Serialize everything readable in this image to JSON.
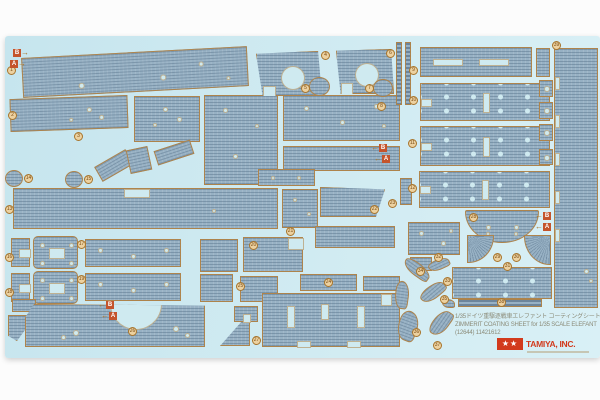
{
  "sheet": {
    "x": 5,
    "y": 36,
    "w": 595,
    "h": 322
  },
  "palette": {
    "sheet_bg": "#cfeaf1",
    "piece": "#97b1c4",
    "ridge": "rgba(54,80,106,0.30)",
    "outline": "#b08246",
    "hole": "#cfeaf0",
    "label_bg": "#ecd1a0",
    "label_ring": "#a8752c",
    "marker_bg": "#c4542c",
    "marker_text": "#ffffff",
    "footer_text": "#8b8b78",
    "logo_red": "#d23a1c"
  },
  "footer": {
    "line_jp": "1/35ドイツ重駆逐戦車エレファント コーティングシートセット",
    "line_en": "ZIMMERIT COATING SHEET for 1/35 SCALE ELEFANT",
    "line_code": "(12644) 11421612",
    "logo_stars": "★★",
    "logo_text": "TAMIYA, INC."
  },
  "pieces": [
    {
      "id": "hull-top-band",
      "x": 22,
      "y": 52,
      "w": 226,
      "h": 40,
      "rot": -3,
      "holes": [
        {
          "x": 140,
          "y": 26,
          "r": 3
        },
        {
          "x": 58,
          "y": 30,
          "r": 3
        },
        {
          "x": 178,
          "y": 14,
          "r": 2.5
        },
        {
          "x": 205,
          "y": 30,
          "r": 2
        }
      ]
    },
    {
      "id": "band-2",
      "x": 10,
      "y": 97,
      "w": 118,
      "h": 33,
      "rot": -2,
      "holes": [
        {
          "x": 78,
          "y": 12,
          "r": 2.5
        },
        {
          "x": 90,
          "y": 20,
          "r": 2.5
        },
        {
          "x": 60,
          "y": 22,
          "r": 2
        }
      ]
    },
    {
      "id": "band-3",
      "x": 134,
      "y": 96,
      "w": 66,
      "h": 46,
      "holes": [
        {
          "x": 30,
          "y": 12,
          "r": 2.5
        },
        {
          "x": 44,
          "y": 22,
          "r": 2.5
        },
        {
          "x": 20,
          "y": 28,
          "r": 2
        }
      ]
    },
    {
      "id": "center-tall",
      "x": 204,
      "y": 95,
      "w": 74,
      "h": 90,
      "holes": [
        {
          "x": 20,
          "y": 14,
          "r": 2.5
        },
        {
          "x": 52,
          "y": 30,
          "r": 2
        },
        {
          "x": 30,
          "y": 60,
          "r": 2.5
        }
      ]
    },
    {
      "id": "wide-band",
      "x": 283,
      "y": 95,
      "w": 117,
      "h": 46,
      "holes": [
        {
          "x": 22,
          "y": 12,
          "r": 2.5
        },
        {
          "x": 58,
          "y": 26,
          "r": 2.5
        },
        {
          "x": 92,
          "y": 10,
          "r": 2.5
        },
        {
          "x": 100,
          "y": 30,
          "r": 2
        }
      ]
    },
    {
      "id": "wide-band-2",
      "x": 283,
      "y": 146,
      "w": 117,
      "h": 25
    },
    {
      "id": "small-holes-bar",
      "x": 258,
      "y": 169,
      "w": 57,
      "h": 17,
      "holes": [
        {
          "x": 14,
          "y": 8,
          "r": 2
        },
        {
          "x": 40,
          "y": 8,
          "r": 2
        }
      ]
    },
    {
      "id": "trap-hole-1",
      "x": 256,
      "y": 51,
      "w": 66,
      "h": 45,
      "clip": "polygon(0 6%, 94% 0, 100% 100%, 10% 100%)",
      "holes": [
        {
          "x": 36,
          "y": 26,
          "r": 12
        }
      ],
      "cuts": [
        {
          "x": 6,
          "y": 34,
          "w": 13,
          "h": 12
        }
      ]
    },
    {
      "id": "trap-hole-2",
      "x": 336,
      "y": 49,
      "w": 58,
      "h": 45,
      "clip": "polygon(0 4%, 95% 0, 100% 100%, 8% 100%)",
      "holes": [
        {
          "x": 30,
          "y": 25,
          "r": 12
        }
      ],
      "cuts": [
        {
          "x": 4,
          "y": 33,
          "w": 12,
          "h": 13
        }
      ]
    },
    {
      "id": "disc-5",
      "x": 309,
      "y": 77,
      "w": 21,
      "h": 19,
      "shape": "disc"
    },
    {
      "id": "disc-7",
      "x": 373,
      "y": 79,
      "w": 20,
      "h": 18,
      "shape": "disc"
    },
    {
      "id": "strip-1",
      "x": 396,
      "y": 42,
      "w": 6,
      "h": 63,
      "dash": true
    },
    {
      "id": "strip-2",
      "x": 405,
      "y": 42,
      "w": 6,
      "h": 63,
      "dash": true
    },
    {
      "id": "slot-bar",
      "x": 420,
      "y": 47,
      "w": 112,
      "h": 30,
      "cuts": [
        {
          "x": 12,
          "y": 11,
          "w": 30,
          "h": 7
        },
        {
          "x": 58,
          "y": 11,
          "w": 30,
          "h": 7
        }
      ]
    },
    {
      "id": "bar-end",
      "x": 536,
      "y": 48,
      "w": 14,
      "h": 29
    },
    {
      "id": "skirt-1",
      "x": 420,
      "y": 83,
      "w": 130,
      "h": 38,
      "dots": true,
      "cuts": [
        {
          "x": 0,
          "y": 15,
          "w": 11,
          "h": 8
        },
        {
          "x": 62,
          "y": 9,
          "w": 7,
          "h": 20
        }
      ]
    },
    {
      "id": "skirt-2",
      "x": 420,
      "y": 126,
      "w": 130,
      "h": 40,
      "dots": true,
      "cuts": [
        {
          "x": 0,
          "y": 16,
          "w": 11,
          "h": 8
        },
        {
          "x": 62,
          "y": 10,
          "w": 7,
          "h": 20
        }
      ]
    },
    {
      "id": "skirt-3",
      "x": 419,
      "y": 171,
      "w": 131,
      "h": 37,
      "dots": true,
      "cuts": [
        {
          "x": 0,
          "y": 14,
          "w": 11,
          "h": 8
        },
        {
          "x": 62,
          "y": 8,
          "w": 7,
          "h": 20
        }
      ]
    },
    {
      "id": "tall-right",
      "x": 554,
      "y": 48,
      "w": 44,
      "h": 260,
      "cuts": [
        {
          "x": 0,
          "y": 28,
          "w": 5,
          "h": 13
        },
        {
          "x": 0,
          "y": 66,
          "w": 5,
          "h": 13
        },
        {
          "x": 0,
          "y": 104,
          "w": 5,
          "h": 13
        },
        {
          "x": 0,
          "y": 142,
          "w": 5,
          "h": 13
        },
        {
          "x": 0,
          "y": 180,
          "w": 5,
          "h": 13
        }
      ],
      "holes": [
        {
          "x": 31,
          "y": 222,
          "r": 2.5
        },
        {
          "x": 36,
          "y": 232,
          "r": 2
        }
      ]
    },
    {
      "id": "eyelet-sq-1",
      "x": 539,
      "y": 80,
      "w": 14,
      "h": 17,
      "holes": [
        {
          "x": 7,
          "y": 8,
          "r": 3
        }
      ]
    },
    {
      "id": "eyelet-sq-2",
      "x": 539,
      "y": 102,
      "w": 14,
      "h": 17,
      "holes": [
        {
          "x": 7,
          "y": 8,
          "r": 3
        }
      ]
    },
    {
      "id": "eyelet-sq-3",
      "x": 539,
      "y": 124,
      "w": 14,
      "h": 17,
      "holes": [
        {
          "x": 7,
          "y": 8,
          "r": 3
        }
      ]
    },
    {
      "id": "eyelet-sq-4",
      "x": 539,
      "y": 149,
      "w": 14,
      "h": 16,
      "holes": [
        {
          "x": 7,
          "y": 8,
          "r": 3
        }
      ]
    },
    {
      "id": "disc-14",
      "x": 5,
      "y": 170,
      "w": 18,
      "h": 17,
      "shape": "disc"
    },
    {
      "id": "disc-15",
      "x": 65,
      "y": 171,
      "w": 18,
      "h": 17,
      "shape": "disc"
    },
    {
      "id": "sliver-1",
      "x": 96,
      "y": 157,
      "w": 36,
      "h": 17,
      "rot": -30
    },
    {
      "id": "sliver-2",
      "x": 128,
      "y": 148,
      "w": 22,
      "h": 24,
      "rot": -12
    },
    {
      "id": "sliver-3",
      "x": 155,
      "y": 145,
      "w": 38,
      "h": 15,
      "rot": -18
    },
    {
      "id": "mid-band",
      "x": 13,
      "y": 188,
      "w": 265,
      "h": 41,
      "cuts": [
        {
          "x": 110,
          "y": 0,
          "w": 26,
          "h": 9
        }
      ],
      "holes": [
        {
          "x": 200,
          "y": 22,
          "r": 2
        }
      ]
    },
    {
      "id": "bracket-a",
      "x": 11,
      "y": 238,
      "w": 19,
      "h": 29,
      "cuts": [
        {
          "x": 7,
          "y": 10,
          "w": 12,
          "h": 9
        }
      ]
    },
    {
      "id": "plate-a",
      "x": 33,
      "y": 236,
      "w": 45,
      "h": 33,
      "round": 5,
      "cuts": [
        {
          "x": 15,
          "y": 11,
          "w": 16,
          "h": 11
        }
      ],
      "holes": [
        {
          "x": 8,
          "y": 8,
          "r": 2.5
        },
        {
          "x": 37,
          "y": 8,
          "r": 2.5
        },
        {
          "x": 8,
          "y": 26,
          "r": 2.5
        },
        {
          "x": 37,
          "y": 26,
          "r": 2.5
        }
      ]
    },
    {
      "id": "wide-a",
      "x": 85,
      "y": 239,
      "w": 96,
      "h": 28,
      "holes": [
        {
          "x": 14,
          "y": 10,
          "r": 2.5
        },
        {
          "x": 47,
          "y": 16,
          "r": 2.5
        },
        {
          "x": 80,
          "y": 10,
          "r": 2.5
        }
      ]
    },
    {
      "id": "bracket-b",
      "x": 11,
      "y": 273,
      "w": 19,
      "h": 29,
      "cuts": [
        {
          "x": 7,
          "y": 10,
          "w": 12,
          "h": 9
        }
      ]
    },
    {
      "id": "plate-b",
      "x": 33,
      "y": 271,
      "w": 45,
      "h": 33,
      "round": 5,
      "cuts": [
        {
          "x": 15,
          "y": 11,
          "w": 16,
          "h": 11
        }
      ],
      "holes": [
        {
          "x": 8,
          "y": 8,
          "r": 2.5
        },
        {
          "x": 37,
          "y": 8,
          "r": 2.5
        },
        {
          "x": 8,
          "y": 26,
          "r": 2.5
        },
        {
          "x": 37,
          "y": 26,
          "r": 2.5
        }
      ]
    },
    {
      "id": "wide-b",
      "x": 85,
      "y": 273,
      "w": 96,
      "h": 28,
      "holes": [
        {
          "x": 14,
          "y": 10,
          "r": 2.5
        },
        {
          "x": 47,
          "y": 16,
          "r": 2.5
        },
        {
          "x": 80,
          "y": 10,
          "r": 2.5
        }
      ]
    },
    {
      "id": "mid-sm-1",
      "x": 200,
      "y": 239,
      "w": 38,
      "h": 33
    },
    {
      "id": "mid-sm-2",
      "x": 243,
      "y": 237,
      "w": 60,
      "h": 35,
      "cuts": [
        {
          "x": 44,
          "y": 0,
          "w": 16,
          "h": 12
        }
      ]
    },
    {
      "id": "vert-holes",
      "x": 282,
      "y": 189,
      "w": 36,
      "h": 39,
      "holes": [
        {
          "x": 12,
          "y": 10,
          "r": 2
        },
        {
          "x": 26,
          "y": 24,
          "r": 2
        }
      ]
    },
    {
      "id": "slant-piece",
      "x": 320,
      "y": 187,
      "w": 65,
      "h": 30,
      "clip": "polygon(0 0, 100% 8%, 86% 100%, 0 100%)"
    },
    {
      "id": "short-wide",
      "x": 315,
      "y": 226,
      "w": 80,
      "h": 22
    },
    {
      "id": "low-sm-1",
      "x": 200,
      "y": 274,
      "w": 33,
      "h": 28
    },
    {
      "id": "low-sm-2",
      "x": 240,
      "y": 276,
      "w": 38,
      "h": 26
    },
    {
      "id": "low-hole",
      "x": 300,
      "y": 274,
      "w": 57,
      "h": 17,
      "holes": [
        {
          "x": 28,
          "y": 8,
          "r": 4
        }
      ]
    },
    {
      "id": "low-sm-3",
      "x": 363,
      "y": 276,
      "w": 37,
      "h": 15
    },
    {
      "id": "tiny-1",
      "x": 12,
      "y": 299,
      "w": 24,
      "h": 13
    },
    {
      "id": "wedge",
      "x": 8,
      "y": 315,
      "w": 28,
      "h": 26,
      "clip": "polygon(0 0, 100% 0, 32% 100%, 0 80%)"
    },
    {
      "id": "bottom-left-big",
      "x": 25,
      "y": 304,
      "w": 180,
      "h": 43,
      "clip": "polygon(5% 0, 100% 4%, 100% 100%, 0 100%, 0 32%)",
      "cuts": [
        {
          "x": 84,
          "y": -27,
          "w": 52,
          "h": 52,
          "roundcut": true
        }
      ],
      "holes": [
        {
          "x": 50,
          "y": 28,
          "r": 3
        },
        {
          "x": 37,
          "y": 32,
          "r": 2.5
        },
        {
          "x": 150,
          "y": 24,
          "r": 3
        },
        {
          "x": 161,
          "y": 30,
          "r": 2.5
        }
      ]
    },
    {
      "id": "tri",
      "x": 220,
      "y": 312,
      "w": 30,
      "h": 34,
      "clip": "polygon(100% 0, 100% 100%, 0 100%)"
    },
    {
      "id": "tri-notch",
      "x": 234,
      "y": 306,
      "w": 24,
      "h": 16,
      "cuts": [
        {
          "x": 8,
          "y": 7,
          "w": 8,
          "h": 9
        }
      ]
    },
    {
      "id": "big-slot",
      "x": 262,
      "y": 293,
      "w": 138,
      "h": 54,
      "cuts": [
        {
          "x": 24,
          "y": 12,
          "w": 8,
          "h": 22
        },
        {
          "x": 58,
          "y": 10,
          "w": 8,
          "h": 16
        },
        {
          "x": 94,
          "y": 12,
          "w": 8,
          "h": 22
        },
        {
          "x": 118,
          "y": 0,
          "w": 11,
          "h": 12
        },
        {
          "x": 34,
          "y": 47,
          "w": 14,
          "h": 7
        },
        {
          "x": 84,
          "y": 47,
          "w": 14,
          "h": 7
        }
      ]
    },
    {
      "id": "sm-vert",
      "x": 400,
      "y": 178,
      "w": 12,
      "h": 27
    },
    {
      "id": "plate-r",
      "x": 408,
      "y": 222,
      "w": 52,
      "h": 33,
      "holes": [
        {
          "x": 12,
          "y": 10,
          "r": 2.5
        },
        {
          "x": 34,
          "y": 20,
          "r": 2.5
        },
        {
          "x": 42,
          "y": 8,
          "r": 2
        }
      ]
    },
    {
      "id": "sm-2",
      "x": 410,
      "y": 257,
      "w": 22,
      "h": 14
    },
    {
      "id": "half-disc",
      "x": 465,
      "y": 210,
      "w": 74,
      "h": 33,
      "shape": "half",
      "holes": [
        {
          "x": 22,
          "y": 16,
          "r": 2.5
        },
        {
          "x": 50,
          "y": 16,
          "r": 2.5
        },
        {
          "x": 22,
          "y": 23,
          "r": 2
        },
        {
          "x": 50,
          "y": 23,
          "r": 2
        }
      ]
    },
    {
      "id": "fan-left",
      "x": 467,
      "y": 235,
      "w": 27,
      "h": 28,
      "shape": "fanl"
    },
    {
      "id": "fan-right",
      "x": 524,
      "y": 235,
      "w": 27,
      "h": 30,
      "shape": "fanr"
    },
    {
      "id": "cres-1",
      "x": 402,
      "y": 263,
      "w": 30,
      "h": 13,
      "rot": 35,
      "shape": "cres"
    },
    {
      "id": "cres-2",
      "x": 428,
      "y": 259,
      "w": 22,
      "h": 11,
      "rot": -25,
      "shape": "cres"
    },
    {
      "id": "cres-3",
      "x": 395,
      "y": 281,
      "w": 14,
      "h": 28,
      "rot": 8,
      "shape": "cres"
    },
    {
      "id": "cres-4",
      "x": 419,
      "y": 285,
      "w": 28,
      "h": 14,
      "rot": -40,
      "shape": "cres"
    },
    {
      "id": "cres-5",
      "x": 398,
      "y": 311,
      "w": 20,
      "h": 30,
      "rot": 20,
      "shape": "cres"
    },
    {
      "id": "cres-6",
      "x": 427,
      "y": 315,
      "w": 28,
      "h": 16,
      "rot": -55,
      "shape": "cres"
    },
    {
      "id": "cres-7",
      "x": 442,
      "y": 299,
      "w": 13,
      "h": 9,
      "shape": "cres"
    },
    {
      "id": "bottom-band",
      "x": 452,
      "y": 267,
      "w": 100,
      "h": 32,
      "dots": true
    },
    {
      "id": "thin-strip",
      "x": 458,
      "y": 299,
      "w": 84,
      "h": 8,
      "dash": true
    }
  ],
  "labels": [
    {
      "n": "1",
      "x": 11,
      "y": 70
    },
    {
      "n": "2",
      "x": 12,
      "y": 115
    },
    {
      "n": "3",
      "x": 78,
      "y": 136
    },
    {
      "n": "4",
      "x": 325,
      "y": 55
    },
    {
      "n": "5",
      "x": 305,
      "y": 88
    },
    {
      "n": "6",
      "x": 390,
      "y": 53
    },
    {
      "n": "7",
      "x": 369,
      "y": 88
    },
    {
      "n": "8",
      "x": 381,
      "y": 106
    },
    {
      "n": "9",
      "x": 413,
      "y": 70
    },
    {
      "n": "10",
      "x": 413,
      "y": 100
    },
    {
      "n": "11",
      "x": 412,
      "y": 143
    },
    {
      "n": "12",
      "x": 412,
      "y": 188
    },
    {
      "n": "13",
      "x": 9,
      "y": 209
    },
    {
      "n": "14",
      "x": 28,
      "y": 178
    },
    {
      "n": "15",
      "x": 88,
      "y": 179
    },
    {
      "n": "16",
      "x": 9,
      "y": 257
    },
    {
      "n": "17",
      "x": 81,
      "y": 244
    },
    {
      "n": "18",
      "x": 9,
      "y": 292
    },
    {
      "n": "19",
      "x": 81,
      "y": 279
    },
    {
      "n": "20",
      "x": 253,
      "y": 245
    },
    {
      "n": "21",
      "x": 290,
      "y": 231
    },
    {
      "n": "22",
      "x": 374,
      "y": 209
    },
    {
      "n": "23",
      "x": 392,
      "y": 203
    },
    {
      "n": "24",
      "x": 328,
      "y": 282
    },
    {
      "n": "25",
      "x": 240,
      "y": 286
    },
    {
      "n": "26",
      "x": 132,
      "y": 331
    },
    {
      "n": "27",
      "x": 256,
      "y": 340
    },
    {
      "n": "28",
      "x": 473,
      "y": 217
    },
    {
      "n": "29",
      "x": 497,
      "y": 257
    },
    {
      "n": "30",
      "x": 516,
      "y": 257
    },
    {
      "n": "31",
      "x": 507,
      "y": 266
    },
    {
      "n": "32",
      "x": 438,
      "y": 257
    },
    {
      "n": "33",
      "x": 447,
      "y": 281
    },
    {
      "n": "34",
      "x": 420,
      "y": 271
    },
    {
      "n": "35",
      "x": 444,
      "y": 299
    },
    {
      "n": "36",
      "x": 416,
      "y": 332
    },
    {
      "n": "37",
      "x": 437,
      "y": 345
    },
    {
      "n": "38",
      "x": 501,
      "y": 302
    },
    {
      "n": "39",
      "x": 556,
      "y": 45
    }
  ],
  "markers": [
    {
      "ch": "B",
      "x": 13,
      "y": 49,
      "dir": "r"
    },
    {
      "ch": "A",
      "x": 10,
      "y": 60,
      "dir": "r"
    },
    {
      "ch": "B",
      "x": 380,
      "y": 144,
      "dir": "l"
    },
    {
      "ch": "A",
      "x": 383,
      "y": 155,
      "dir": "l"
    },
    {
      "ch": "B",
      "x": 544,
      "y": 212,
      "dir": "l"
    },
    {
      "ch": "A",
      "x": 544,
      "y": 223,
      "dir": "l"
    },
    {
      "ch": "B",
      "x": 107,
      "y": 301,
      "dir": "l"
    },
    {
      "ch": "A",
      "x": 110,
      "y": 312,
      "dir": "l"
    }
  ]
}
